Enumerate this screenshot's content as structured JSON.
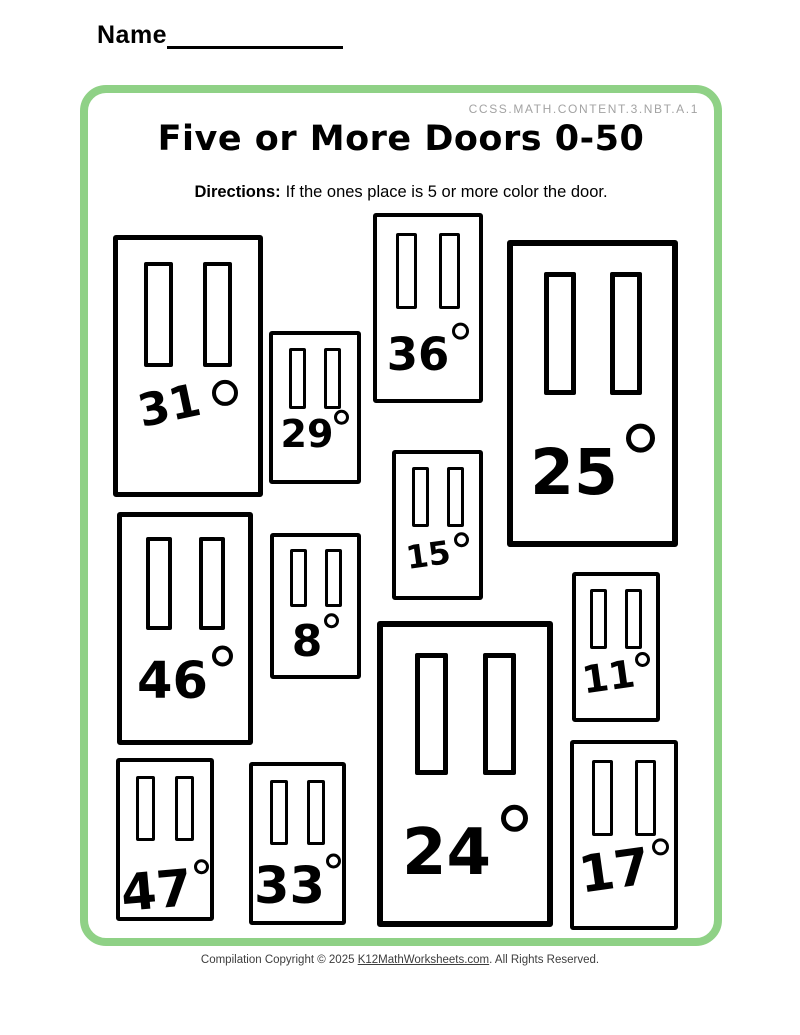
{
  "page": {
    "name_label": "Name",
    "standard": "CCSS.MATH.CONTENT.3.NBT.A.1",
    "title": "Five or More Doors 0-50",
    "directions_label": "Directions:",
    "directions_text": "If the ones place is 5 or more color the door.",
    "accent_green": "#8fd186",
    "footer": {
      "prefix": "Compilation Copyright © 2025 ",
      "link_text": "K12MathWorksheets.com",
      "suffix": ". All Rights Reserved."
    }
  },
  "doors": [
    {
      "number": "31"
    },
    {
      "number": "36"
    },
    {
      "number": "29"
    },
    {
      "number": "25"
    },
    {
      "number": "15"
    },
    {
      "number": "46"
    },
    {
      "number": "8"
    },
    {
      "number": "11"
    },
    {
      "number": "24"
    },
    {
      "number": "47"
    },
    {
      "number": "33"
    },
    {
      "number": "17"
    }
  ]
}
